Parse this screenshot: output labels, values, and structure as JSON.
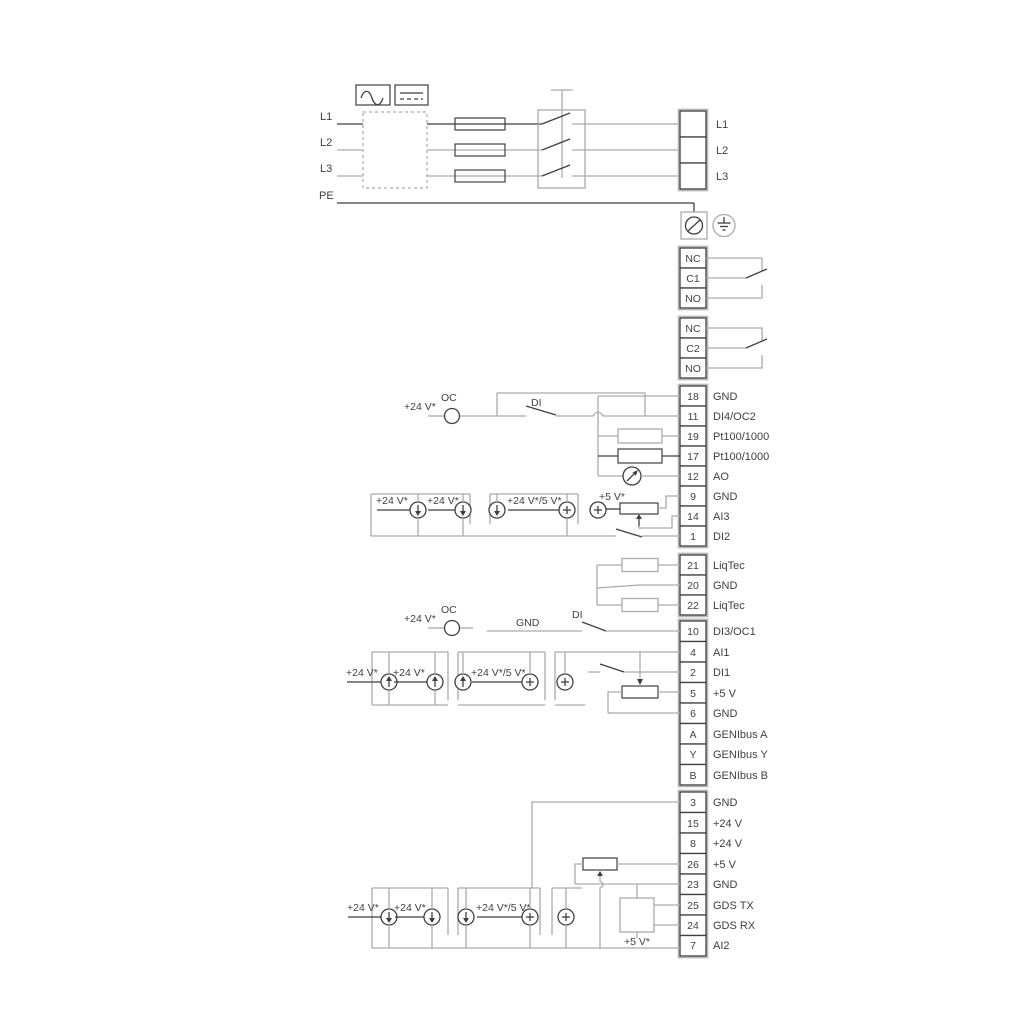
{
  "power": {
    "l1": "L1",
    "l2": "L2",
    "l3": "L3",
    "pe": "PE",
    "r1": "L1",
    "r2": "L2",
    "r3": "L3"
  },
  "relay1": {
    "nc": "NC",
    "c": "C1",
    "no": "NO"
  },
  "relay2": {
    "nc": "NC",
    "c": "C2",
    "no": "NO"
  },
  "strip1": {
    "rows": [
      {
        "n": "18",
        "t": "GND"
      },
      {
        "n": "11",
        "t": "DI4/OC2"
      },
      {
        "n": "19",
        "t": "Pt100/1000"
      },
      {
        "n": "17",
        "t": "Pt100/1000"
      },
      {
        "n": "12",
        "t": "AO"
      },
      {
        "n": "9",
        "t": "GND"
      },
      {
        "n": "14",
        "t": "AI3"
      },
      {
        "n": "1",
        "t": "DI2"
      }
    ]
  },
  "liqtec": {
    "rows": [
      {
        "n": "21",
        "t": "LiqTec"
      },
      {
        "n": "20",
        "t": "GND"
      },
      {
        "n": "22",
        "t": "LiqTec"
      }
    ]
  },
  "strip3": {
    "rows": [
      {
        "n": "10",
        "t": "DI3/OC1"
      },
      {
        "n": "4",
        "t": "AI1"
      },
      {
        "n": "2",
        "t": "DI1"
      },
      {
        "n": "5",
        "t": "+5 V"
      },
      {
        "n": "6",
        "t": "GND"
      },
      {
        "n": "A",
        "t": "GENIbus A"
      },
      {
        "n": "Y",
        "t": "GENIbus Y"
      },
      {
        "n": "B",
        "t": "GENIbus B"
      }
    ]
  },
  "strip4": {
    "rows": [
      {
        "n": "3",
        "t": "GND"
      },
      {
        "n": "15",
        "t": "+24 V"
      },
      {
        "n": "8",
        "t": "+24 V"
      },
      {
        "n": "26",
        "t": "+5 V"
      },
      {
        "n": "23",
        "t": "GND"
      },
      {
        "n": "25",
        "t": "GDS TX"
      },
      {
        "n": "24",
        "t": "GDS RX"
      },
      {
        "n": "7",
        "t": "AI2"
      }
    ]
  },
  "oc2": {
    "v24": "+24 V*",
    "oc": "OC",
    "di": "DI"
  },
  "ai3": {
    "v24a": "+24 V*",
    "v24b": "+24 V*",
    "v245": "+24 V*/5 V*",
    "v5": "+5 V*"
  },
  "oc1": {
    "v24": "+24 V*",
    "oc": "OC",
    "gnd": "GND",
    "di": "DI"
  },
  "ai1": {
    "v24a": "+24 V*",
    "v24b": "+24 V*",
    "v245": "+24 V*/5 V*"
  },
  "ai2": {
    "v24a": "+24 V*",
    "v24b": "+24 V*",
    "v245": "+24 V*/5 V*",
    "v5": "+5 V*"
  },
  "colors": {
    "wire_grey": "#ababab",
    "wire_black": "#3f3f3f",
    "background": "#ffffff"
  }
}
